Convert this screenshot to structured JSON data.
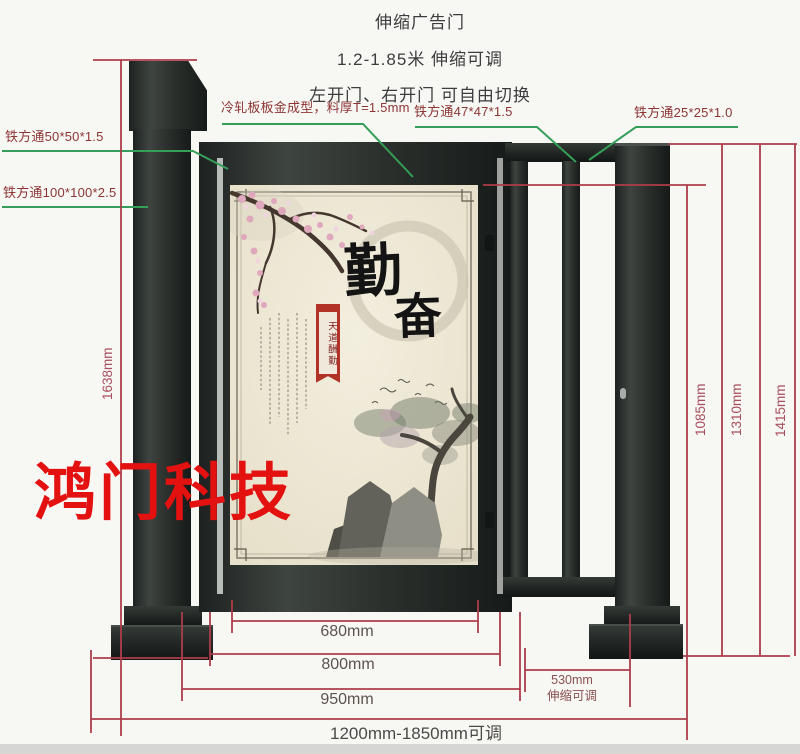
{
  "title": {
    "line1": "伸缩广告门",
    "line2": "1.2-1.85米 伸缩可调",
    "line3": "左开门、右开门 可自由切换"
  },
  "watermark": "鸿门科技",
  "callouts": {
    "tube_50": "铁方通50*50*1.5",
    "tube_100": "铁方通100*100*2.5",
    "cold_rolled_sheet": "冷轧板板金成型，料厚T=1.5mm",
    "tube_47": "铁方通47*47*1.5",
    "tube_25": "铁方通25*25*1.0"
  },
  "dimensions": {
    "post_height": "1638mm",
    "inner_height": "1085mm",
    "mid_height": "1310mm",
    "frame_height": "1415mm",
    "panel_width": "680mm",
    "door_width": "800mm",
    "frame_width": "950mm",
    "slide_width": "530mm",
    "slide_note": "伸缩可调",
    "total_width": "1200mm-1850mm可调"
  },
  "poster": {
    "calligraphy_top": "勤",
    "calligraphy_bottom": "奋",
    "banner": "天道酬勤"
  },
  "colors": {
    "metal": "#2b302d",
    "dimension_line": "#ad3d4a",
    "leader_line": "#359e58",
    "callout_text": "#8d3535",
    "watermark_red": "#e41111",
    "poster_bg": "#ece6d4"
  }
}
